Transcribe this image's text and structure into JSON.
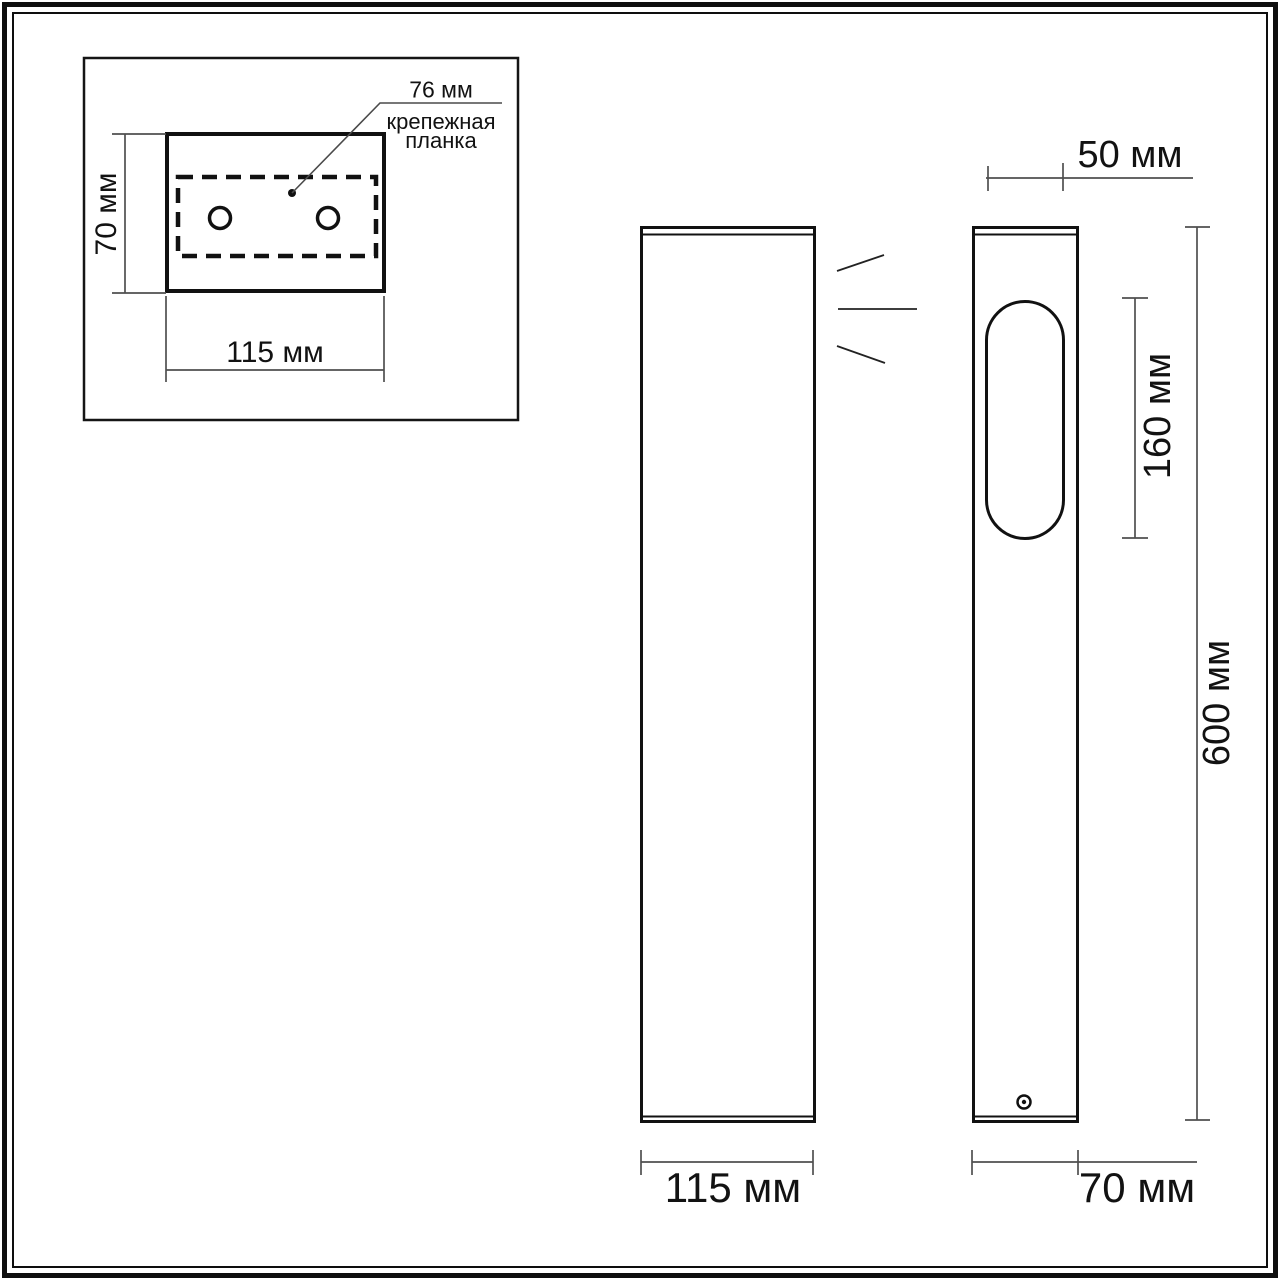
{
  "page": {
    "background": "#ffffff",
    "line_color": "#111111",
    "dim_line_color": "#555555"
  },
  "inset": {
    "hole_spacing_label": "76 мм",
    "mounting_plate_label": "крепежная планка",
    "height_label": "70 мм",
    "width_label": "115 мм"
  },
  "front_view": {
    "width_label": "115 мм"
  },
  "side_view": {
    "top_width_label": "50 мм",
    "window_height_label": "160 мм",
    "height_label": "600 мм",
    "width_label": "70 мм"
  }
}
